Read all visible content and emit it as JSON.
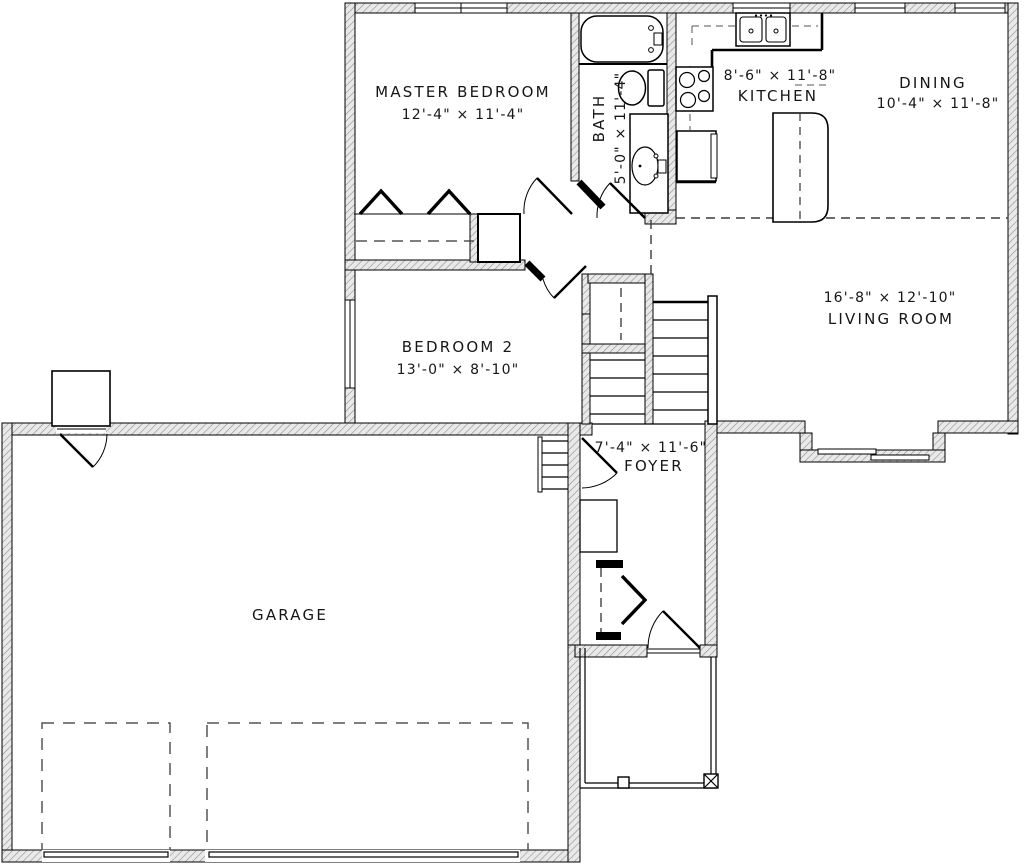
{
  "drawing": {
    "type": "floor-plan",
    "background": "#ffffff",
    "wall_hatch_color": "#eaeaea",
    "line_color": "#000000"
  },
  "rooms": {
    "master_bedroom": {
      "name": "MASTER BEDROOM",
      "dims": "12'-4\" × 11'-4\""
    },
    "bath": {
      "name": "BATH",
      "dims": "5'-0\" × 11'-4\""
    },
    "kitchen": {
      "name": "KITCHEN",
      "dims": "8'-6\" × 11'-8\""
    },
    "dining": {
      "name": "DINING",
      "dims": "10'-4\" × 11'-8\""
    },
    "living_room": {
      "name": "LIVING ROOM",
      "dims": "16'-8\" × 12'-10\""
    },
    "bedroom_2": {
      "name": "BEDROOM 2",
      "dims": "13'-0\" × 8'-10\""
    },
    "foyer": {
      "name": "FOYER",
      "dims": "7'-4\" × 11'-6\""
    },
    "garage": {
      "name": "GARAGE"
    }
  },
  "fixtures": {
    "bath": [
      "bathtub",
      "toilet",
      "vanity-sink"
    ],
    "kitchen": [
      "double-sink",
      "range",
      "refrigerator",
      "island"
    ],
    "other": [
      "stairs",
      "porch",
      "stoop",
      "garage-bays"
    ]
  }
}
